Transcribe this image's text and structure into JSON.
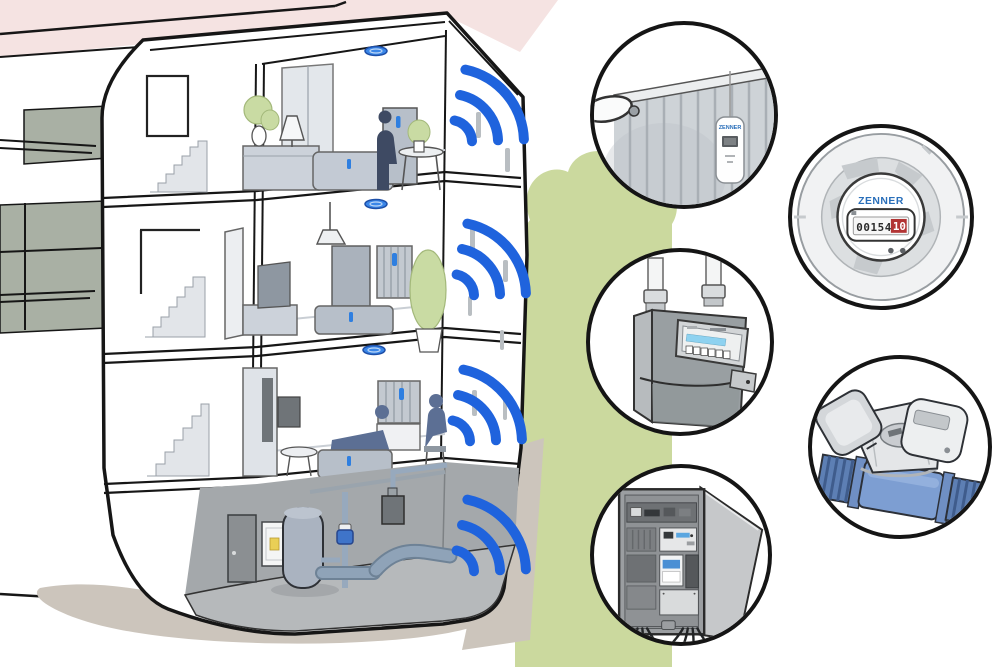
{
  "colors": {
    "wifi_blue": "#1f63dd",
    "device_blue": "#2f7fe0",
    "bush_green": "#cbd99e",
    "roof_pink": "#f5e3e2",
    "ground_beige": "#ccc5bc",
    "water_meter_blue": "#7d9ed2",
    "counter_red": "#b23434",
    "brand_blue": "#2a6fba"
  },
  "building": {
    "floor_count": 4,
    "wifi_signal_count": 4
  },
  "callouts": [
    {
      "id": "radiator-heat-cost-allocator",
      "brand_label": "ZENNER"
    },
    {
      "id": "radio-meter-module",
      "brand_label": "ZENNER",
      "counter_black_digits": "00154",
      "counter_red_digits": "10"
    },
    {
      "id": "gas-meter"
    },
    {
      "id": "mechanical-water-meter"
    },
    {
      "id": "electric-distribution-cabinet"
    }
  ]
}
